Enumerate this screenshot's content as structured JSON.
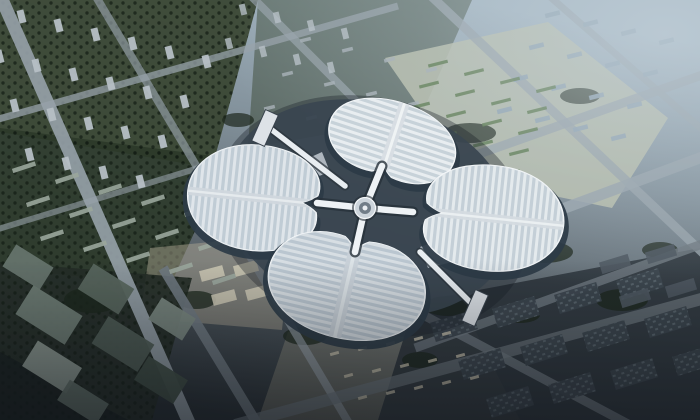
{
  "meta": {
    "alt": "Aerial architectural rendering of a four-leaf-clover shaped exhibition complex surrounded by a hazy blue-gray city grid",
    "width": 700,
    "height": 420
  },
  "palette": {
    "bg_top": "#a9bac6",
    "bg_upper": "#8496a2",
    "bg_mid": "#5f6a72",
    "bg_bottom": "#23292e",
    "haze": "#c6d3dc",
    "road_light": "#97a2aa",
    "road_mid": "#6e787f",
    "green_dark": "#2b3829",
    "green_mid": "#3a4734",
    "tree": "#1c271c",
    "roof_base": "#ccd6de",
    "roof_rib": "#f3f6f8",
    "roof_spine": "#dde3e8",
    "under": "#2c3b47",
    "podium": "#3a4550",
    "wedge": "#c2cad1",
    "hub_outer": "#ccd4db",
    "hub_inner": "#717d88",
    "arm": "#eef2f5",
    "block_light": "#b6bfc5",
    "block_haze": "#8fa3b1",
    "block_slate": "#3b454d",
    "plaza": "#b3ab96",
    "parking_ground": "#b9beac",
    "parking_green": "#5d7b50",
    "pavilion": "#dde2e7",
    "walk_dark": "#2c353e",
    "walk_light": "#e8edf1"
  },
  "scene": {
    "patches": [
      {
        "pts": [
          [
            0,
            0
          ],
          [
            258,
            0
          ],
          [
            212,
            168
          ],
          [
            0,
            132
          ]
        ],
        "fill": "green_mid",
        "op": 0.95
      },
      {
        "pts": [
          [
            0,
            128
          ],
          [
            228,
            158
          ],
          [
            170,
            286
          ],
          [
            0,
            268
          ]
        ],
        "fill": "green_dark",
        "op": 0.9
      },
      {
        "pts": [
          [
            0,
            0
          ],
          [
            258,
            0
          ],
          [
            212,
            168
          ],
          [
            0,
            132
          ]
        ],
        "fill": "url(#treetex)",
        "op": 1
      },
      {
        "pts": [
          [
            0,
            128
          ],
          [
            228,
            158
          ],
          [
            170,
            286
          ],
          [
            0,
            268
          ]
        ],
        "fill": "url(#treetex)",
        "op": 1
      },
      {
        "pts": [
          [
            258,
            0
          ],
          [
            472,
            0
          ],
          [
            420,
            118
          ],
          [
            248,
            148
          ]
        ],
        "fill": "green_mid",
        "op": 0.5
      },
      {
        "pts": [
          [
            385,
            58
          ],
          [
            548,
            22
          ],
          [
            668,
            118
          ],
          [
            612,
            208
          ],
          [
            468,
            178
          ]
        ],
        "fill": "parking_ground",
        "op": 0.85
      },
      {
        "pts": [
          [
            150,
            248
          ],
          [
            292,
            234
          ],
          [
            282,
            330
          ],
          [
            140,
            318
          ]
        ],
        "fill": "plaza",
        "op": 0.45
      },
      {
        "pts": [
          [
            288,
            332
          ],
          [
            470,
            320
          ],
          [
            520,
            420
          ],
          [
            258,
            420
          ]
        ],
        "fill": "plaza",
        "op": 0.35
      },
      {
        "pts": [
          [
            0,
            262
          ],
          [
            192,
            278
          ],
          [
            152,
            420
          ],
          [
            0,
            420
          ]
        ],
        "fill": "#242c26",
        "op": 0.92
      },
      {
        "pts": [
          [
            0,
            262
          ],
          [
            192,
            278
          ],
          [
            152,
            420
          ],
          [
            0,
            420
          ]
        ],
        "fill": "url(#treetex)",
        "op": 1
      },
      {
        "pts": [
          [
            415,
            302
          ],
          [
            700,
            248
          ],
          [
            700,
            420
          ],
          [
            378,
            420
          ]
        ],
        "fill": "#2b333a",
        "op": 0.88
      },
      {
        "ellipse": [
          470,
          133,
          26,
          10
        ],
        "fill": "tree",
        "op": 0.75
      },
      {
        "ellipse": [
          545,
          252,
          28,
          11
        ],
        "fill": "tree",
        "op": 0.75
      },
      {
        "ellipse": [
          448,
          306,
          24,
          10
        ],
        "fill": "tree",
        "op": 0.75
      },
      {
        "ellipse": [
          305,
          336,
          22,
          9
        ],
        "fill": "tree",
        "op": 0.75
      },
      {
        "ellipse": [
          196,
          300,
          20,
          9
        ],
        "fill": "tree",
        "op": 0.75
      },
      {
        "ellipse": [
          622,
          300,
          26,
          11
        ],
        "fill": "tree",
        "op": 0.75
      },
      {
        "ellipse": [
          580,
          96,
          20,
          8
        ],
        "fill": "tree",
        "op": 0.7
      },
      {
        "ellipse": [
          92,
          300,
          28,
          13
        ],
        "fill": "tree",
        "op": 0.8
      },
      {
        "ellipse": [
          238,
          120,
          16,
          7
        ],
        "fill": "tree",
        "op": 0.7
      },
      {
        "ellipse": [
          660,
          250,
          18,
          8
        ],
        "fill": "tree",
        "op": 0.7
      },
      {
        "ellipse": [
          520,
          315,
          20,
          8
        ],
        "fill": "tree",
        "op": 0.75
      },
      {
        "ellipse": [
          420,
          360,
          18,
          8
        ],
        "fill": "tree",
        "op": 0.75
      },
      {
        "pts": [
          [
            0,
            352
          ],
          [
            128,
            420
          ],
          [
            0,
            420
          ]
        ],
        "fill": "#141a1d",
        "op": 0.6
      }
    ],
    "roads": [
      {
        "l": [
          0,
          -5,
          190,
          425
        ],
        "w": 13,
        "c": "road_light",
        "op": 0.9
      },
      {
        "l": [
          95,
          -5,
          350,
          425
        ],
        "w": 8,
        "c": "road_light",
        "op": 0.65
      },
      {
        "l": [
          250,
          -5,
          425,
          170
        ],
        "w": 8,
        "c": "road_light",
        "op": 0.7
      },
      {
        "l": [
          430,
          -5,
          705,
          255
        ],
        "w": 9,
        "c": "road_light",
        "op": 0.8
      },
      {
        "l": [
          548,
          -5,
          705,
          132
        ],
        "w": 7,
        "c": "road_light",
        "op": 0.7
      },
      {
        "l": [
          380,
          292,
          630,
          425
        ],
        "w": 9,
        "c": "road_mid",
        "op": 0.8
      },
      {
        "l": [
          163,
          268,
          258,
          425
        ],
        "w": 10,
        "c": "road_mid",
        "op": 0.9
      },
      {
        "l": [
          -5,
          120,
          398,
          6
        ],
        "w": 7,
        "c": "road_light",
        "op": 0.75
      },
      {
        "l": [
          -5,
          230,
          215,
          163
        ],
        "w": 6,
        "c": "road_light",
        "op": 0.6
      },
      {
        "l": [
          428,
          172,
          705,
          74
        ],
        "w": 9,
        "c": "road_light",
        "op": 0.8
      },
      {
        "l": [
          452,
          250,
          705,
          156
        ],
        "w": 11,
        "c": "road_light",
        "op": 0.85
      },
      {
        "l": [
          415,
          348,
          705,
          243
        ],
        "w": 9,
        "c": "road_mid",
        "op": 0.8
      },
      {
        "l": [
          235,
          425,
          705,
          298
        ],
        "w": 12,
        "c": "road_mid",
        "op": 0.7
      }
    ],
    "building_rows": [
      {
        "x": 18,
        "y": 10,
        "cols": 6,
        "rows": 4,
        "cdx": 37,
        "cdy": 9,
        "rdx": -22,
        "rdy": 40,
        "w": 7,
        "h": 13,
        "rot": -14,
        "fill": "block_light",
        "op": 0.95
      },
      {
        "x": 240,
        "y": 4,
        "cols": 4,
        "rows": 2,
        "cdx": 34,
        "cdy": 8,
        "rdx": -14,
        "rdy": 34,
        "w": 6,
        "h": 11,
        "rot": -14,
        "fill": "block_light",
        "op": 0.8
      },
      {
        "x": 545,
        "y": 12,
        "cols": 4,
        "rows": 4,
        "cdx": 38,
        "cdy": 9,
        "rdx": -16,
        "rdy": 32,
        "w": 15,
        "h": 4.5,
        "rot": -14,
        "fill": "block_haze",
        "op": 0.9
      },
      {
        "x": 300,
        "y": 38,
        "cols": 4,
        "rows": 3,
        "cdx": 42,
        "cdy": 10,
        "rdx": -18,
        "rdy": 34,
        "w": 11,
        "h": 3.5,
        "rot": -14,
        "fill": "#a3adb3",
        "op": 0.85
      },
      {
        "x": 428,
        "y": 62,
        "cols": 4,
        "rows": 5,
        "cdx": 36,
        "cdy": 8.5,
        "rdx": -9,
        "rdy": 21,
        "w": 20,
        "h": 3.2,
        "rot": -14,
        "fill": "parking_green",
        "op": 0.9
      },
      {
        "x": 12,
        "y": 165,
        "cols": 5,
        "rows": 3,
        "cdx": 43,
        "cdy": 11,
        "rdx": 14,
        "rdy": 34,
        "w": 24,
        "h": 4.5,
        "rot": -18,
        "fill": "#9aa69c",
        "op": 0.9
      },
      {
        "x": 432,
        "y": 316,
        "cols": 4,
        "rows": 3,
        "cdx": 62,
        "cdy": -14,
        "rdx": 28,
        "rdy": 38,
        "w": 44,
        "h": 20,
        "rot": -17,
        "fill": "block_slate",
        "op": 0.95
      },
      {
        "x": 432,
        "y": 316,
        "cols": 4,
        "rows": 3,
        "cdx": 62,
        "cdy": -14,
        "rdx": 28,
        "rdy": 38,
        "w": 44,
        "h": 20,
        "rot": -17,
        "fill": "url(#roofdots)",
        "op": 0.9
      },
      {
        "x": 600,
        "y": 258,
        "cols": 2,
        "rows": 2,
        "cdx": 46,
        "cdy": -10,
        "rdx": 20,
        "rdy": 34,
        "w": 30,
        "h": 12,
        "rot": -17,
        "fill": "#4c575f",
        "op": 0.9
      },
      {
        "x": 330,
        "y": 352,
        "cols": 5,
        "rows": 3,
        "cdx": 28,
        "cdy": -5,
        "rdx": 14,
        "rdy": 22,
        "w": 9,
        "h": 3,
        "rot": -15,
        "fill": "#c9c3ae",
        "op": 0.8
      },
      {
        "x": 200,
        "y": 268,
        "cols": 3,
        "rows": 2,
        "cdx": 34,
        "cdy": -5,
        "rdx": 12,
        "rdy": 24,
        "w": 24,
        "h": 11,
        "rot": -15,
        "fill": "#c8c3b0",
        "op": 0.9
      }
    ],
    "boxes": [
      {
        "x": 6,
        "y": 254,
        "w": 44,
        "h": 26,
        "fill": "#65736b"
      },
      {
        "x": 20,
        "y": 298,
        "w": 58,
        "h": 34,
        "fill": "#6d7b73"
      },
      {
        "x": 82,
        "y": 274,
        "w": 48,
        "h": 30,
        "fill": "#57655d"
      },
      {
        "x": 26,
        "y": 352,
        "w": 52,
        "h": 30,
        "fill": "#8a968e"
      },
      {
        "x": 96,
        "y": 328,
        "w": 54,
        "h": 32,
        "fill": "#4d5b53"
      },
      {
        "x": 152,
        "y": 306,
        "w": 40,
        "h": 26,
        "fill": "#77857d"
      },
      {
        "x": 60,
        "y": 390,
        "w": 46,
        "h": 24,
        "fill": "#606e66"
      },
      {
        "x": 138,
        "y": 366,
        "w": 46,
        "h": 28,
        "fill": "#3f4d45"
      }
    ],
    "box_rot": 32
  },
  "building": {
    "petal_path": "M0,-88 C50,-88 88,-52 88,-2 C88,50 52,82 14,74 C8,69 4,63 0,55 C-4,63 -8,69 -14,74 C-52,82 -88,50 -88,-2 C-88,-52 -50,-88 0,-88 Z",
    "petals": [
      {
        "name": "north",
        "cx": 392,
        "cy": 142,
        "rot": 18,
        "sx": 0.74,
        "sy": 0.46,
        "shade": 0.05
      },
      {
        "name": "west",
        "cx": 258,
        "cy": 198,
        "rot": -84,
        "sx": 0.6,
        "sy": 0.8,
        "shade": 0.12
      },
      {
        "name": "east",
        "cx": 489,
        "cy": 218,
        "rot": 96,
        "sx": 0.6,
        "sy": 0.85,
        "shade": 0.08
      },
      {
        "name": "south",
        "cx": 347,
        "cy": 284,
        "rot": 193,
        "sx": 0.9,
        "sy": 0.62,
        "shade": 0.18
      }
    ],
    "hub": {
      "cx": 365,
      "cy": 208
    },
    "arms": [
      [
        382,
        166
      ],
      [
        413,
        212
      ],
      [
        355,
        252
      ],
      [
        317,
        203
      ]
    ],
    "podium": {
      "cx": 368,
      "cy": 208,
      "rx": 146,
      "ry": 106,
      "rot": 14
    },
    "podium_shadow": {
      "cx": 372,
      "cy": 216,
      "rx": 160,
      "ry": 118,
      "rot": 14
    },
    "wedges": [
      [
        [
          428,
          158
        ],
        [
          455,
          168
        ],
        [
          438,
          186
        ],
        [
          415,
          172
        ]
      ],
      [
        [
          420,
          247
        ],
        [
          446,
          238
        ],
        [
          452,
          262
        ],
        [
          428,
          268
        ]
      ],
      [
        [
          296,
          252
        ],
        [
          318,
          262
        ],
        [
          302,
          280
        ],
        [
          282,
          266
        ]
      ],
      [
        [
          300,
          162
        ],
        [
          322,
          152
        ],
        [
          330,
          172
        ],
        [
          308,
          180
        ]
      ]
    ],
    "walkways": [
      {
        "line": [
          345,
          186,
          272,
          130
        ],
        "pav": [
          265,
          128,
          14,
          34,
          24
        ]
      },
      {
        "line": [
          420,
          252,
          470,
          302
        ],
        "pav": [
          475,
          308,
          14,
          34,
          24
        ]
      }
    ]
  }
}
